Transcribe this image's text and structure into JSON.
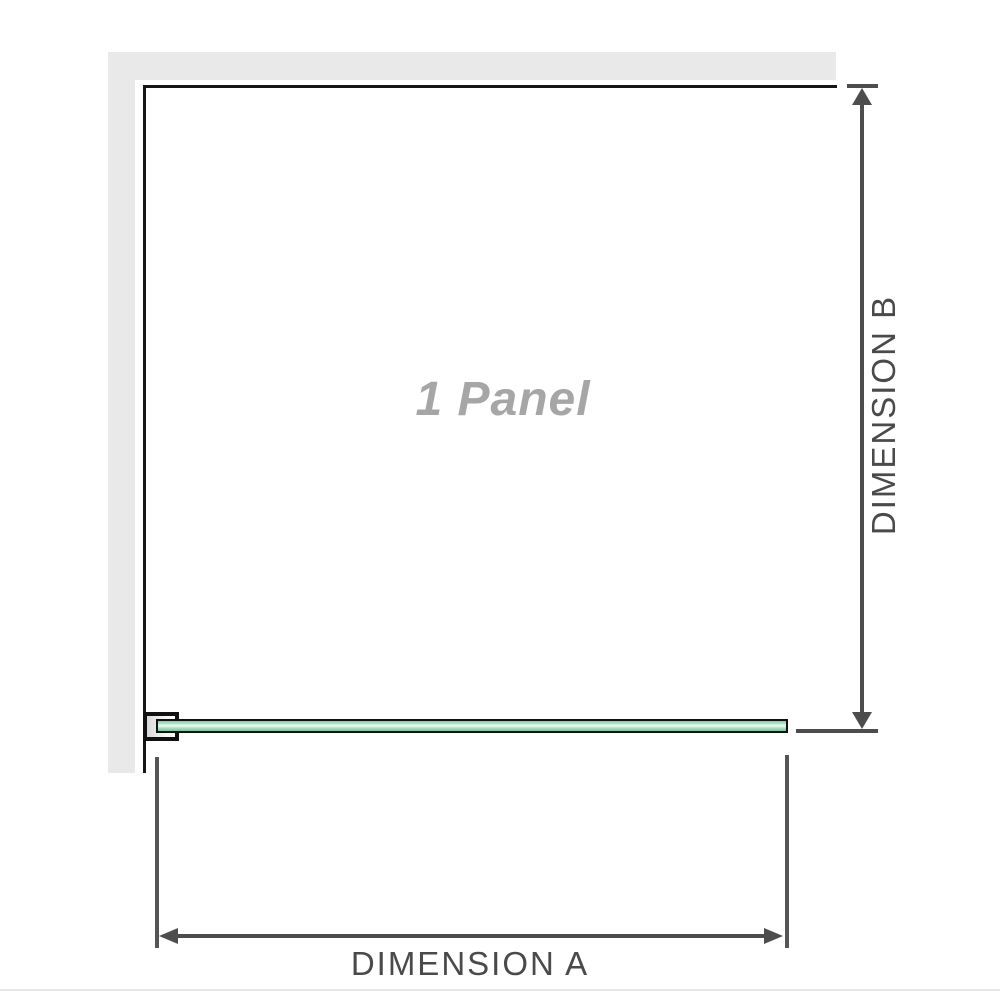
{
  "diagram": {
    "title": "shower screen single panel dimension diagram",
    "panel_label": "1 Panel",
    "dimension_a_label": "DIMENSION A",
    "dimension_b_label": "DIMENSION B"
  },
  "colors": {
    "wall": "#e9e9e9",
    "frame_border": "#161616",
    "glass_green_edge": "#79c99e",
    "glass_green_mid": "#8bd3ac",
    "glass_green_highlight": "#eef8f2",
    "dimension_line": "#4d4d4d",
    "extension_line": "#555555",
    "dimension_label_text": "#4a4a4a",
    "panel_label_text": "#a6a6a6",
    "divider": "#e8e6e2"
  }
}
